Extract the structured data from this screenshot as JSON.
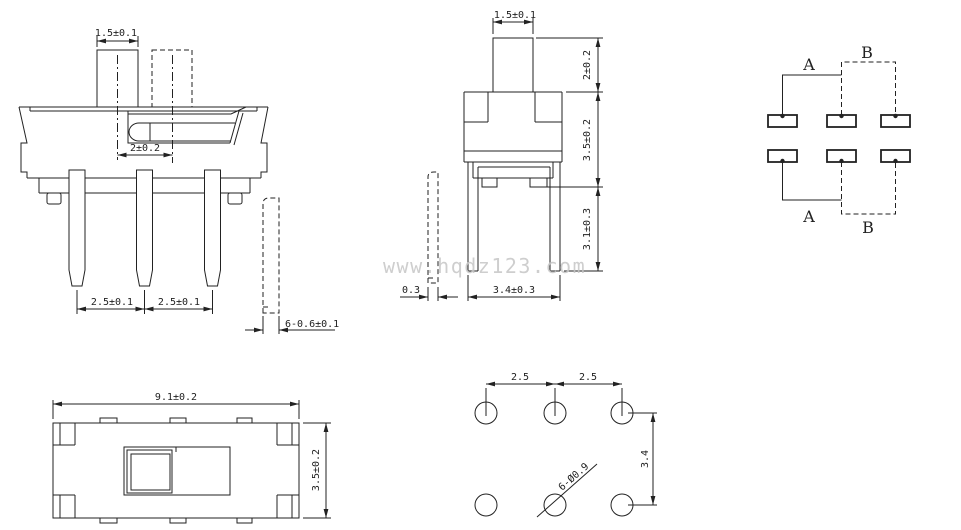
{
  "drawing": {
    "watermark": "www.hqdz123.com",
    "colors": {
      "line": "#222222",
      "watermark": "#c6c6c6",
      "background": "#ffffff"
    },
    "front_view": {
      "knob_width": "1.5±0.1",
      "travel": "2±0.2",
      "pin_pitch_left": "2.5±0.1",
      "pin_pitch_right": "2.5±0.1",
      "pin_width": "6-0.6±0.1"
    },
    "side_view": {
      "knob_width": "1.5±0.1",
      "knob_height": "2±0.2",
      "body_height": "3.5±0.2",
      "pin_length": "3.1±0.3",
      "bracket_width": "3.4±0.3",
      "pin_thickness": "0.3"
    },
    "schematic": {
      "position_a_top": "A",
      "position_b_top": "B",
      "position_a_bottom": "A",
      "position_b_bottom": "B"
    },
    "top_view": {
      "body_width": "9.1±0.2",
      "body_depth": "3.5±0.2"
    },
    "pcb_layout": {
      "hole_pitch_left": "2.5",
      "hole_pitch_right": "2.5",
      "row_spacing": "3.4",
      "hole_spec": "6-Ø0.9"
    }
  }
}
